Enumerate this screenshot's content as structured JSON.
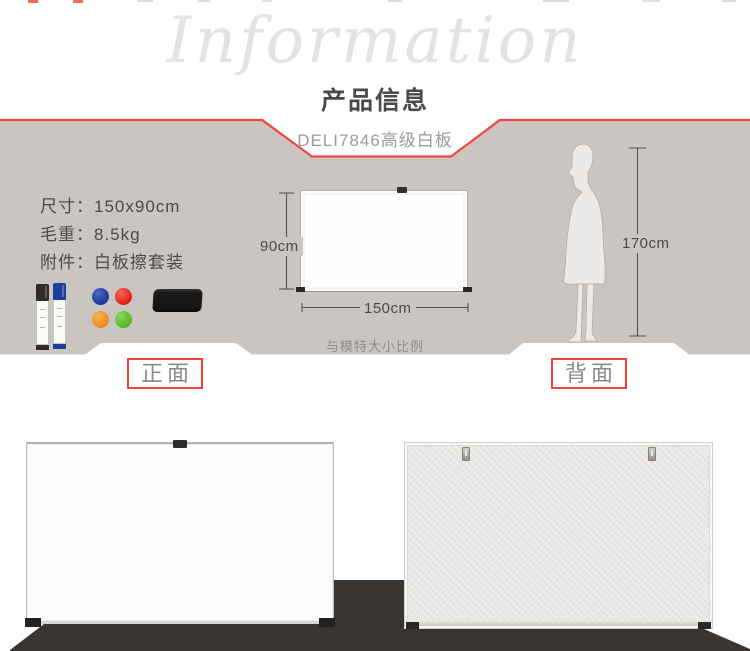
{
  "header": {
    "watermark": "Information",
    "title": "产品信息",
    "subtitle": "DELI7846高级白板"
  },
  "specs": {
    "items": [
      {
        "label": "尺寸：",
        "value": "150x90cm"
      },
      {
        "label": "毛重：",
        "value": "8.5kg"
      },
      {
        "label": "附件：",
        "value": "白板擦套装"
      }
    ]
  },
  "diagram": {
    "board_height_label": "90cm",
    "board_width_label": "150cm",
    "model_height_label": "170cm",
    "scale_note": "与模特大小比例"
  },
  "views": {
    "front_label": "正面",
    "back_label": "背面"
  },
  "icons": [
    "marker-pen-black-icon",
    "marker-pen-blue-icon",
    "magnet-blue-icon",
    "magnet-red-icon",
    "magnet-orange-icon",
    "magnet-green-icon",
    "eraser-icon",
    "model-silhouette-icon"
  ],
  "colors": {
    "accent_red": "#ee4238",
    "section_gray": "#cbc5c1",
    "floor_dark": "#393532",
    "text_dark": "#4a4a4a",
    "text_muted": "#9b9b9b",
    "magnet_blue": "#1e3c96",
    "magnet_red": "#e1251b",
    "magnet_orange": "#f08c1c",
    "magnet_green": "#58bb1f"
  }
}
